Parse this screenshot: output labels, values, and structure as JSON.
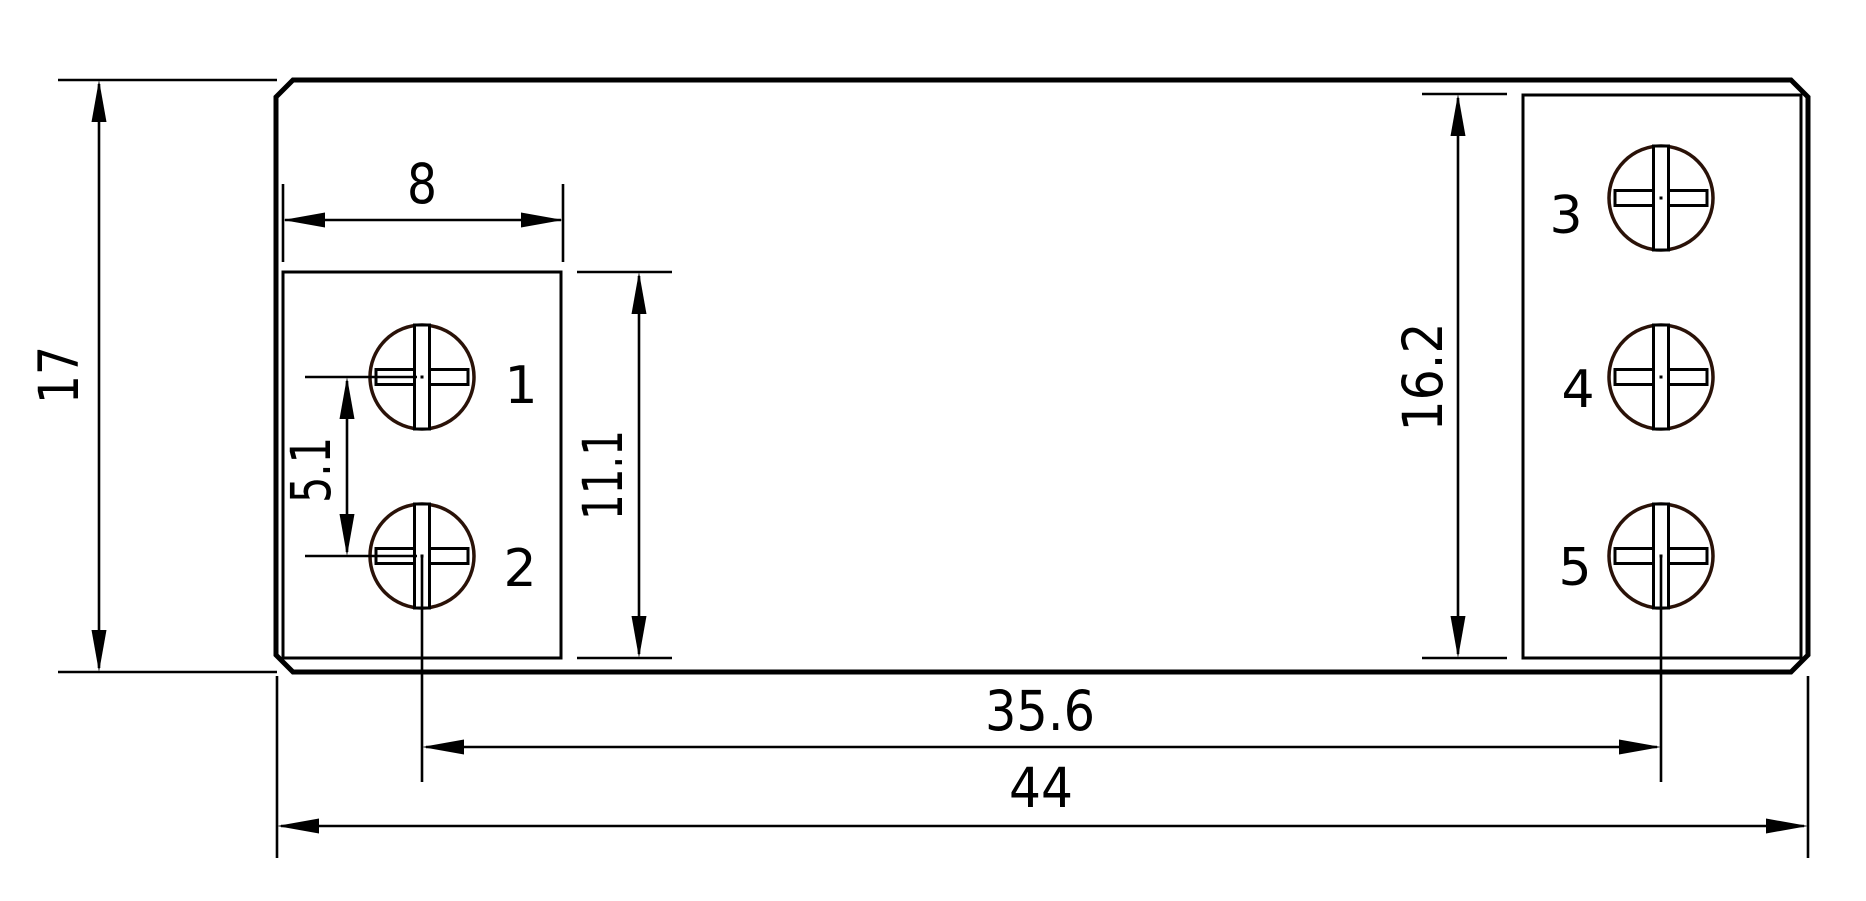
{
  "drawing": {
    "kind": "dimensioned technical drawing",
    "description": "component footprint with five screw terminals"
  },
  "colors": {
    "background": "#ffffff",
    "line": "#000000",
    "accent_red": "#ed1c24",
    "screw_outline": "#2a1208"
  },
  "dims": {
    "overall_height": "17",
    "overall_width": "44",
    "screw_span": "35.6",
    "block_width": "8",
    "screw_pitch": "5.1",
    "left_block_height": "11.1",
    "right_block_height": "16.2"
  },
  "terminals": [
    {
      "label": "1"
    },
    {
      "label": "2"
    },
    {
      "label": "3"
    },
    {
      "label": "4"
    },
    {
      "label": "5"
    }
  ]
}
